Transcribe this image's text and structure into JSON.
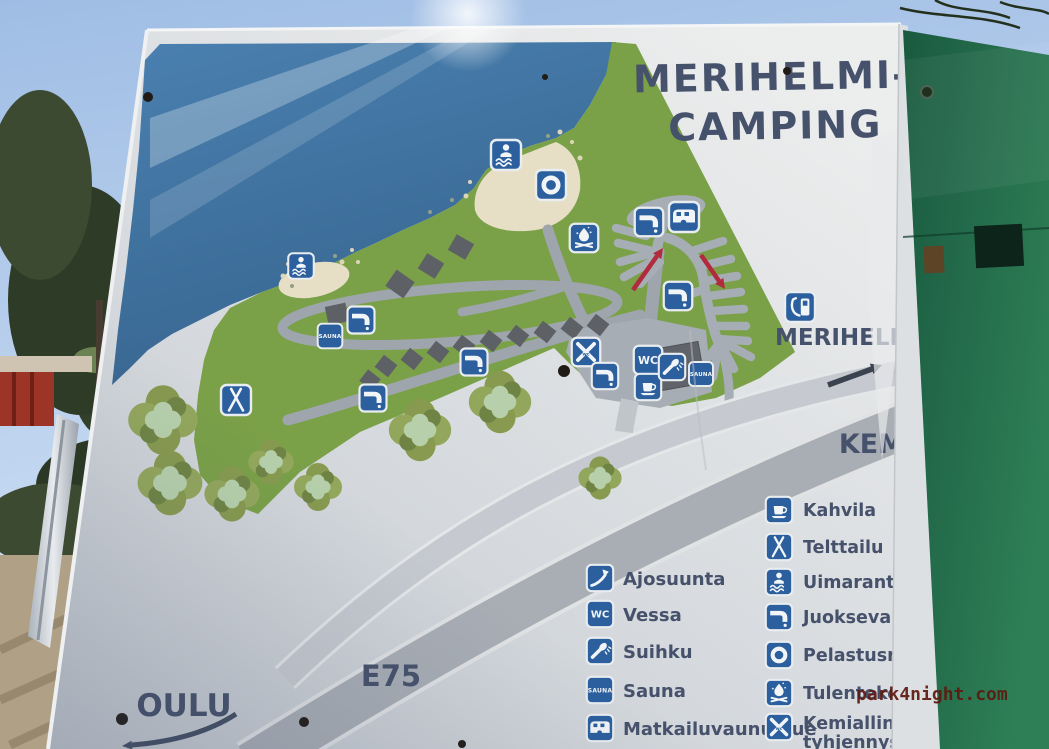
{
  "sign": {
    "title": {
      "line1": "MERIHELMI-",
      "line2": "CAMPING"
    },
    "map_labels": {
      "site": "MERIHELMI",
      "toward_right": "KEMI",
      "toward_left": "OULU",
      "highway": "E75"
    },
    "icon_texts": {
      "wc": "WC",
      "sauna": "SAUNA",
      "chem_wc": "wc"
    },
    "legend_left": [
      {
        "icon": "direction-arrow",
        "label": "Ajosuunta"
      },
      {
        "icon": "wc",
        "label": "Vessa"
      },
      {
        "icon": "shower",
        "label": "Suihku"
      },
      {
        "icon": "sauna",
        "label": "Sauna"
      },
      {
        "icon": "caravan",
        "label": "Matkailuvaunualue"
      }
    ],
    "legend_right": [
      {
        "icon": "coffee-cup",
        "label": "Kahvila"
      },
      {
        "icon": "tent",
        "label": "Telttailu"
      },
      {
        "icon": "swimmer",
        "label": "Uimaranta"
      },
      {
        "icon": "water-tap",
        "label": "Juokseva vesi"
      },
      {
        "icon": "life-ring",
        "label": "Pelastusrengas"
      },
      {
        "icon": "campfire",
        "label": "Tulentekopaikka"
      },
      {
        "icon": "chemical-toilet",
        "label": "Kemiallinen wc:n",
        "label_line2": "tyhjennys"
      }
    ]
  },
  "watermark": "park4night.com",
  "colors": {
    "icon_blue": "#2b5f9e",
    "land_green": "#7aa048",
    "water_blue": "#3e719f",
    "sand": "#e6dfc6",
    "road_grey": "#9ea5ad",
    "highway_grey": "#a9aeb5",
    "direction_arrow_red": "#b12a3e",
    "sign_text_slate": "#46516b",
    "wall_green": "#1f6347",
    "watermark_red": "#5e190f",
    "sky_blue": "#aac6e9"
  }
}
